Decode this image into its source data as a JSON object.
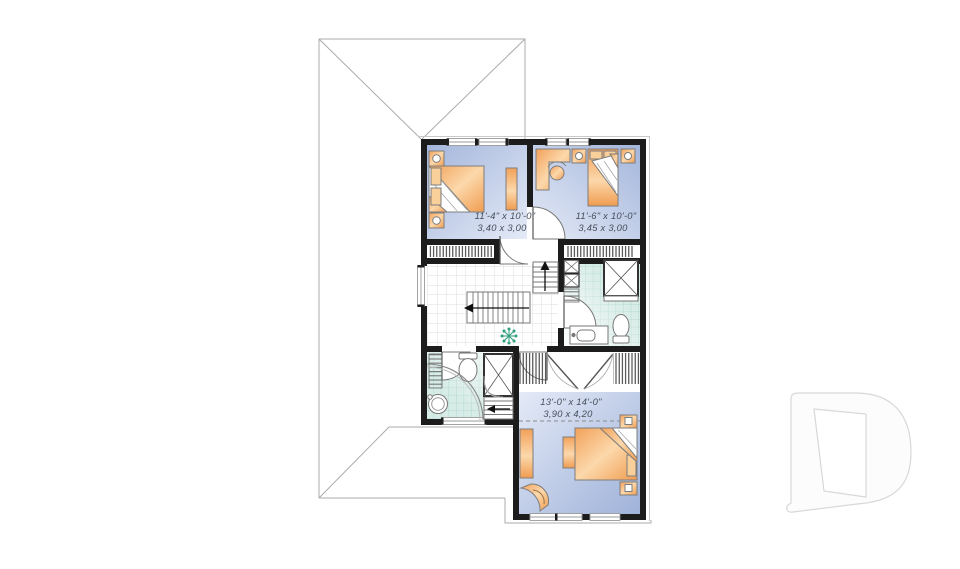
{
  "page": {
    "type": "architectural-floor-plan",
    "background": "#ffffff"
  },
  "rooms": {
    "bedroom_1": {
      "imperial": "11'-4\" x 10'-0\"",
      "metric": "3,40 x 3,00"
    },
    "bedroom_2": {
      "imperial": "11'-6\" x 10'-0\"",
      "metric": "3,45 x 3,00"
    },
    "master_bedroom": {
      "imperial": "13'-0\" x 14'-0\"",
      "metric": "3,90 x 4,20"
    }
  },
  "symbols": [
    "roof-outline",
    "double-bed",
    "single-bed",
    "nightstand-lamp",
    "dresser",
    "desk-with-chair",
    "corner-shower",
    "toilet",
    "vanity-sink",
    "round-sink",
    "closet-rod-hatch",
    "double-closet-doors",
    "door-swing",
    "stairs-with-arrow",
    "plant",
    "window",
    "ceiling-slope-dashed-line",
    "d-logo-watermark"
  ],
  "colors": {
    "wall": "#1c1c1c",
    "bedroom_floor_dark": "#a4b6db",
    "bedroom_floor_light": "#e4eaf7",
    "bath_tile": "#d8ece7",
    "bath_tile_line": "#b2d8d0",
    "hall_tile_line": "#dedede",
    "furniture_orange": "#f2a159",
    "furniture_orange_light": "#fcd8ab",
    "roof_line": "#ababab",
    "dimension_text": "#474e5a",
    "plant_green": "#2f9e7c",
    "watermark_stroke": "#d8d8d8"
  }
}
